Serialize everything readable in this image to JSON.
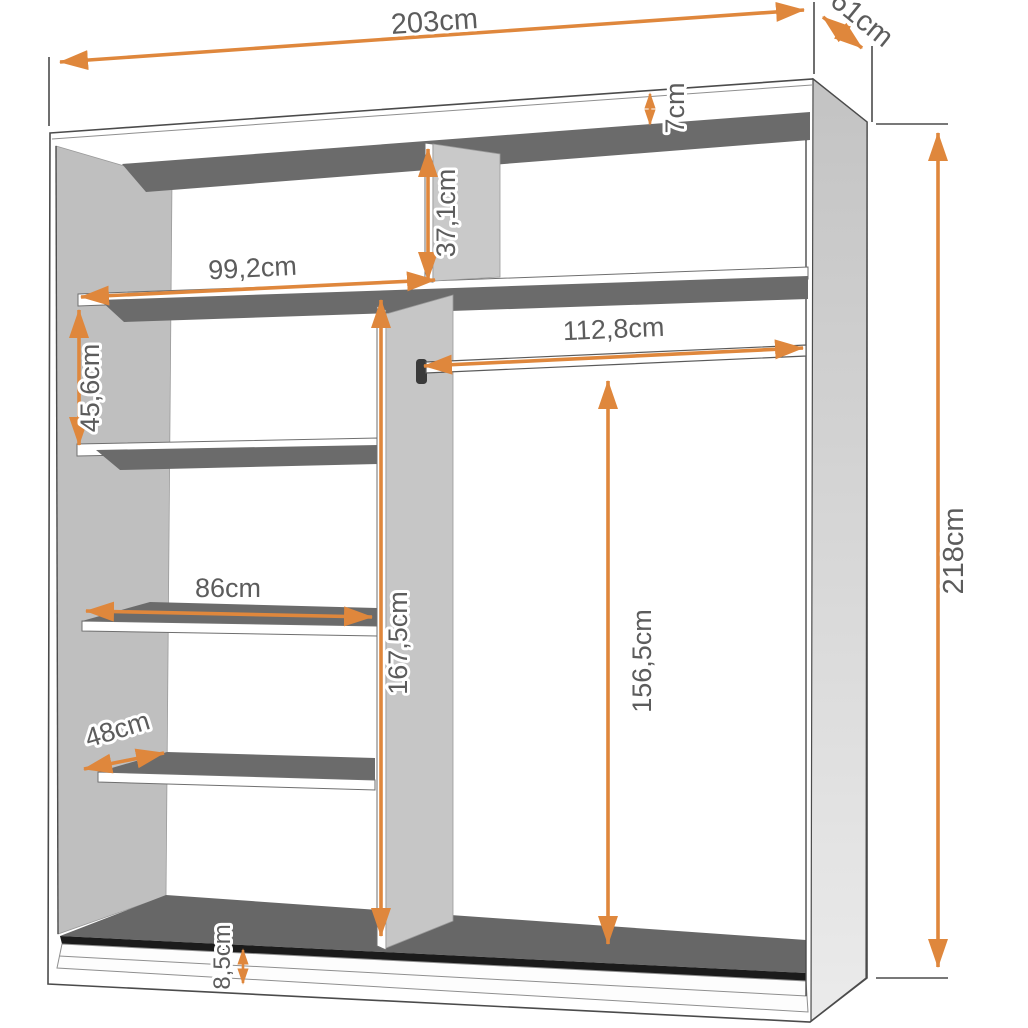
{
  "diagram": {
    "type": "furniture-dimension-diagram",
    "subject": "wardrobe interior with shelves and hanging rail",
    "unit": "cm"
  },
  "dimensions": {
    "total_width": "203cm",
    "depth": "61cm",
    "total_height": "218cm",
    "top_panel_height": "7cm",
    "top_compartment_height": "37,1cm",
    "left_section_width": "99,2cm",
    "shelf_spacing": "45,6cm",
    "hanging_rail_width": "112,8cm",
    "shelf_width": "86cm",
    "divider_height": "167,5cm",
    "hanging_space_height": "156,5cm",
    "shelf_depth": "48cm",
    "plinth_height": "8,5cm"
  },
  "colors": {
    "accent_orange": "#DF873C",
    "shelf_dark_gray": "#6B6B6B",
    "panel_light_gray": "#BFBFBF",
    "track_black": "#1B1B1B",
    "outline": "#4B4B4B",
    "label_text": "#5C5C5C",
    "background": "#FFFFFF"
  }
}
